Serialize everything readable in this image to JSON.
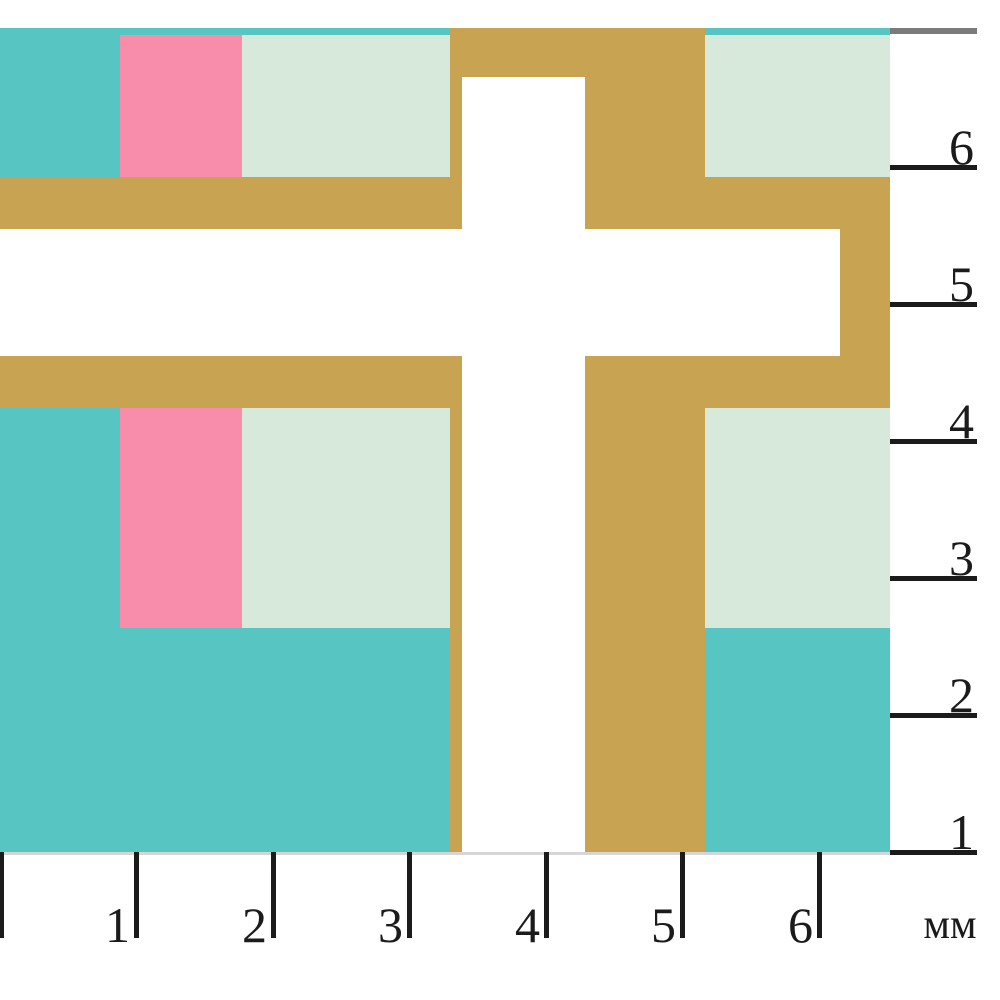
{
  "figure": {
    "colors": {
      "teal": "#57c5c2",
      "pink": "#f78dab",
      "mint": "#d6e9da",
      "gold": "#c8a351",
      "tick": "#1b1b1b",
      "gray_line": "#7b7b7b",
      "baseline": "#d6d6d6"
    },
    "shapes": [
      {
        "name": "teal-top-strip-left",
        "color": "teal",
        "x": 0,
        "y": 28,
        "w": 450,
        "h": 7
      },
      {
        "name": "teal-top-strip-right",
        "color": "teal",
        "x": 705,
        "y": 28,
        "w": 185,
        "h": 7
      },
      {
        "name": "teal-block-upper-left",
        "color": "teal",
        "x": 0,
        "y": 35,
        "w": 120,
        "h": 142
      },
      {
        "name": "pink-block-upper",
        "color": "pink",
        "x": 120,
        "y": 35,
        "w": 122,
        "h": 142
      },
      {
        "name": "mint-block-upper",
        "color": "mint",
        "x": 242,
        "y": 35,
        "w": 208,
        "h": 142
      },
      {
        "name": "mint-block-upper-right",
        "color": "mint",
        "x": 705,
        "y": 35,
        "w": 185,
        "h": 142
      },
      {
        "name": "gold-top-band",
        "color": "gold",
        "x": 450,
        "y": 28,
        "w": 255,
        "h": 49
      },
      {
        "name": "gold-left-wall-upper",
        "color": "gold",
        "x": 450,
        "y": 77,
        "w": 12,
        "h": 100
      },
      {
        "name": "gold-right-column-upper",
        "color": "gold",
        "x": 585,
        "y": 77,
        "w": 120,
        "h": 152
      },
      {
        "name": "gold-band-upper-left",
        "color": "gold",
        "x": 0,
        "y": 177,
        "w": 462,
        "h": 52
      },
      {
        "name": "gold-band-upper-right",
        "color": "gold",
        "x": 585,
        "y": 177,
        "w": 305,
        "h": 52
      },
      {
        "name": "gold-arm-end-wall",
        "color": "gold",
        "x": 840,
        "y": 229,
        "w": 50,
        "h": 127
      },
      {
        "name": "gold-band-lower-left",
        "color": "gold",
        "x": 0,
        "y": 356,
        "w": 462,
        "h": 52
      },
      {
        "name": "gold-band-lower-right",
        "color": "gold",
        "x": 585,
        "y": 356,
        "w": 305,
        "h": 52
      },
      {
        "name": "teal-block-lower-left",
        "color": "teal",
        "x": 0,
        "y": 408,
        "w": 450,
        "h": 444
      },
      {
        "name": "pink-block-lower",
        "color": "pink",
        "x": 120,
        "y": 408,
        "w": 122,
        "h": 220
      },
      {
        "name": "mint-block-lower",
        "color": "mint",
        "x": 242,
        "y": 408,
        "w": 208,
        "h": 220
      },
      {
        "name": "gold-left-wall-lower",
        "color": "gold",
        "x": 450,
        "y": 408,
        "w": 12,
        "h": 444
      },
      {
        "name": "gold-column-lower",
        "color": "gold",
        "x": 585,
        "y": 408,
        "w": 120,
        "h": 444
      },
      {
        "name": "mint-block-lower-right",
        "color": "mint",
        "x": 705,
        "y": 408,
        "w": 185,
        "h": 220
      },
      {
        "name": "teal-block-lower-right",
        "color": "teal",
        "x": 705,
        "y": 628,
        "w": 185,
        "h": 224
      }
    ],
    "right_ruler": {
      "top_line": {
        "x": 890,
        "y": 28,
        "w": 87,
        "h": 6
      },
      "tick_x": 890,
      "tick_w": 87,
      "tick_h": 5,
      "ticks": [
        {
          "label": "6",
          "y": 167
        },
        {
          "label": "5",
          "y": 304
        },
        {
          "label": "4",
          "y": 441
        },
        {
          "label": "3",
          "y": 578
        },
        {
          "label": "2",
          "y": 715
        },
        {
          "label": "1",
          "y": 852
        }
      ]
    },
    "bottom_ruler": {
      "baseline": {
        "x": 0,
        "y": 852,
        "w": 890,
        "h": 3
      },
      "tick_y": 852,
      "tick_w": 5,
      "tick_h": 86,
      "ticks": [
        {
          "label": "",
          "x": 1
        },
        {
          "label": "1",
          "x": 136
        },
        {
          "label": "2",
          "x": 273
        },
        {
          "label": "3",
          "x": 409
        },
        {
          "label": "4",
          "x": 546
        },
        {
          "label": "5",
          "x": 682
        },
        {
          "label": "6",
          "x": 819
        }
      ],
      "unit_label": "мм"
    }
  }
}
